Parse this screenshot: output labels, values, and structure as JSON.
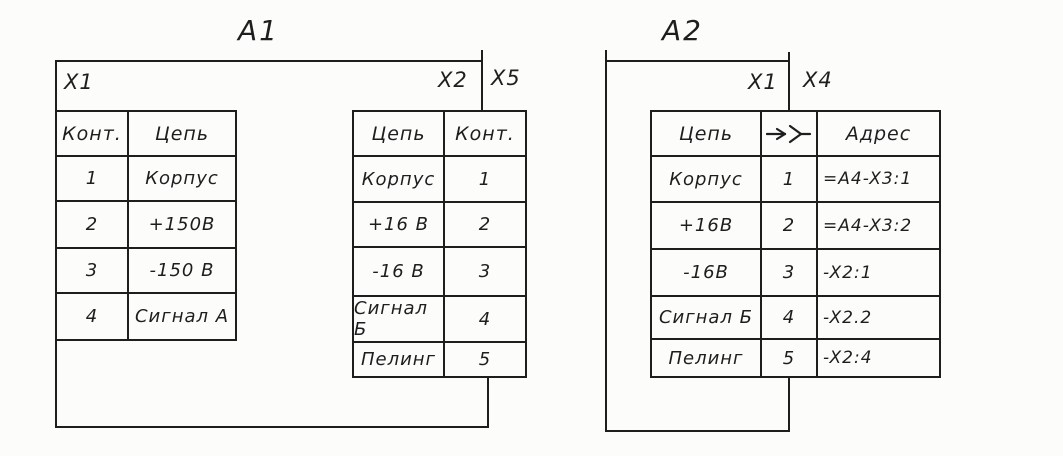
{
  "colors": {
    "ink": "#1e1e1e",
    "paper": "#fcfcfb"
  },
  "a1": {
    "label": "A1",
    "connectors": {
      "x1": "X1",
      "x2": "X2",
      "x5": "X5"
    },
    "left_table": {
      "headers": [
        "Конт.",
        "Цепь"
      ],
      "rows": [
        [
          "1",
          "Корпус"
        ],
        [
          "2",
          "+150В"
        ],
        [
          "3",
          "-150 В"
        ],
        [
          "4",
          "Сигнал А"
        ]
      ]
    },
    "mid_table": {
      "headers": [
        "Цепь",
        "Конт."
      ],
      "rows": [
        [
          "Корпус",
          "1"
        ],
        [
          "+16 В",
          "2"
        ],
        [
          "-16 В",
          "3"
        ],
        [
          "Сигнал Б",
          "4"
        ],
        [
          "Пелинг",
          "5"
        ]
      ]
    }
  },
  "a2": {
    "label": "A2",
    "connectors": {
      "x1": "X1",
      "x4": "X4"
    },
    "table": {
      "header_circuit": "Цепь",
      "header_icon": "detachable-contact-icon",
      "header_address": "Адрес",
      "rows": [
        [
          "Корпус",
          "1",
          "=A4-X3:1"
        ],
        [
          "+16В",
          "2",
          "=A4-X3:2"
        ],
        [
          "-16В",
          "3",
          "-X2:1"
        ],
        [
          "Сигнал Б",
          "4",
          "-X2.2"
        ],
        [
          "Пелинг",
          "5",
          "-X2:4"
        ]
      ]
    }
  }
}
